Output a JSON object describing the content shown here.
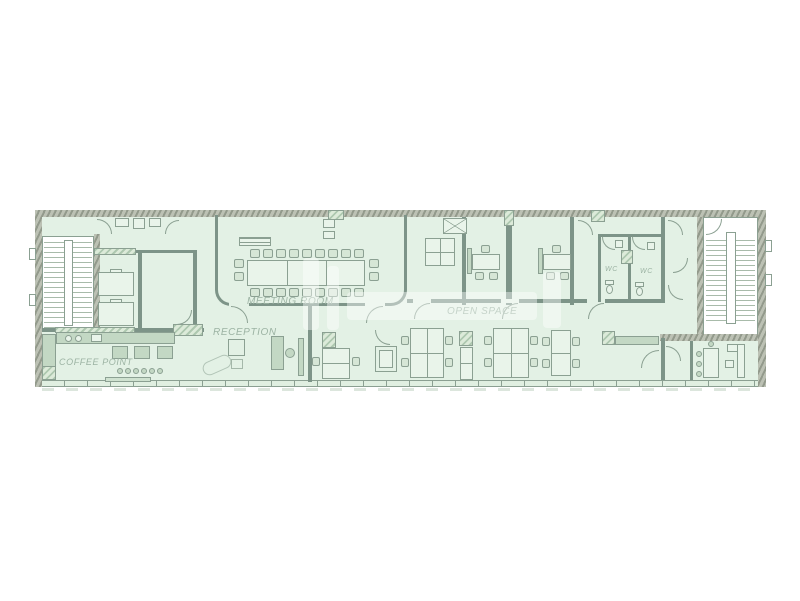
{
  "page": {
    "background": "#ffffff"
  },
  "floor_plan": {
    "type": "office-floor-plan",
    "labels": {
      "meeting_room": "MEETING ROOM",
      "reception": "RECEPTION",
      "open_space": "OPEN SPACE",
      "coffee_point": "COFFEE POINT",
      "wc_left": "WC",
      "wc_right": "WC"
    },
    "colors": {
      "floor_fill": "#e3f1e5",
      "wall_line": "#8ba092",
      "wall_hatch_light": "#bcc1b4",
      "wall_hatch_dark": "#939a8c",
      "furniture_fill": "#cfe2d0",
      "label_text": "#9cb3a3"
    }
  }
}
